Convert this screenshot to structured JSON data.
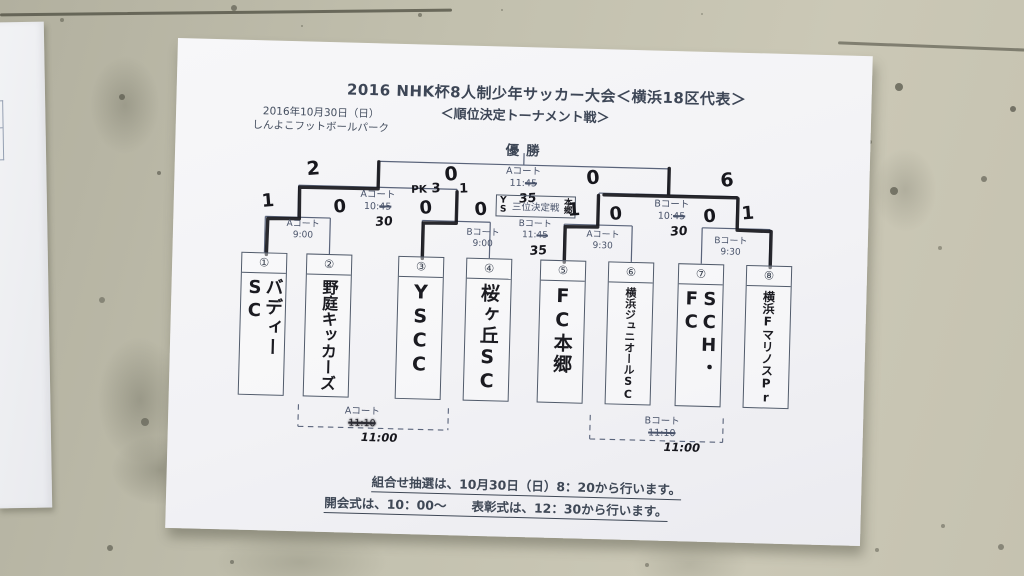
{
  "poster": {
    "title": "2016 NHK杯8人制少年サッカー大会＜横浜18区代表＞",
    "subtitle": "＜順位決定トーナメント戦＞",
    "date": "2016年10月30日（日）",
    "venue": "しんよこフットボールパーク",
    "champion_label": "優勝",
    "teams": [
      {
        "seed": "①",
        "name": "バディーSC"
      },
      {
        "seed": "②",
        "name": "野庭キッカーズ"
      },
      {
        "seed": "③",
        "name": "YSCC"
      },
      {
        "seed": "④",
        "name": "桜ヶ丘SC"
      },
      {
        "seed": "⑤",
        "name": "FC本郷"
      },
      {
        "seed": "⑥",
        "name": "横浜ジュニオールSC"
      },
      {
        "seed": "⑦",
        "name": "SCH・FC"
      },
      {
        "seed": "⑧",
        "name": "横浜FマリノスPr"
      }
    ],
    "first_round": [
      {
        "court": "Aコート",
        "time": "9:00",
        "score_left": "1",
        "score_right": "0"
      },
      {
        "court": "Bコート",
        "time": "9:00",
        "score_left": "0",
        "score_right": "0",
        "pk_label": "PK",
        "pk_left": "3",
        "pk_right": "1"
      },
      {
        "court": "Aコート",
        "time": "9:30",
        "score_left": "1",
        "score_right": "0"
      },
      {
        "court": "Bコート",
        "time": "9:30",
        "score_left": "0",
        "score_right": "1"
      }
    ],
    "semifinals": [
      {
        "court": "Aコート",
        "time_prefix": "10:",
        "time_struck": "45",
        "time_hand": "30",
        "score_left": "2",
        "score_right": "0"
      },
      {
        "court": "Bコート",
        "time_prefix": "10:",
        "time_struck": "45",
        "time_hand": "30",
        "score_left": "0",
        "score_right": "6"
      }
    ],
    "final": {
      "court": "Aコート",
      "time_prefix": "11:",
      "time_struck": "45",
      "time_hand": "35"
    },
    "third_place": {
      "label": "三位決定戦",
      "left_hand": "YS",
      "right_hand": "本郷",
      "court": "Bコート",
      "time_prefix": "11:",
      "time_struck": "45",
      "time_hand": "35"
    },
    "consolation": [
      {
        "court": "Aコート",
        "time_struck": "11:10",
        "time_hand": "11:00"
      },
      {
        "court": "Bコート",
        "time_struck": "11:10",
        "time_hand": "11:00"
      }
    ],
    "notes": [
      "組合せ抽選は、10月30日（日）8：20から行います。",
      "開会式は、10：00～　　表彰式は、12：30から行います。"
    ],
    "colors": {
      "wall": "#c2c0ae",
      "paper": "#f3f3f6",
      "print": "#49536a",
      "marker": "#17171d"
    }
  }
}
